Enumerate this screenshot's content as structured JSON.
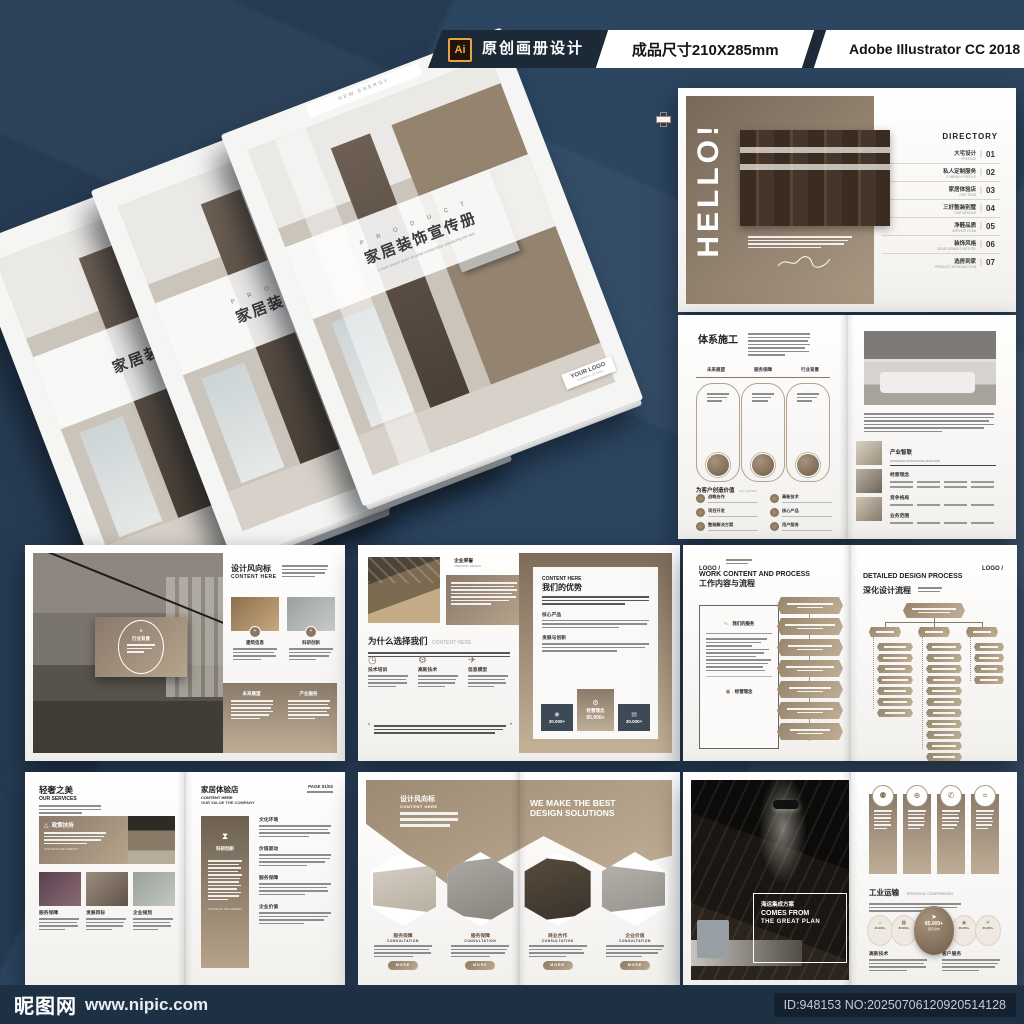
{
  "banner": {
    "ai_badge": "Ai",
    "label": "原创画册设计",
    "size": "成品尺寸210X285mm",
    "software": "Adobe Illustrator CC 2018"
  },
  "footer": {
    "brand": "昵图网",
    "url": "www.nipic.com",
    "id_no": "ID:948153 NO:20250706120920514128"
  },
  "cover": {
    "tab": "NEW ENERGY",
    "eyebrow": "P R O D U C T",
    "title": "家居装饰宣传册",
    "subtitle": "Lorem ipsum dolor sit amet consectetur adipiscing elit sed",
    "logo": "YOUR LOGO",
    "logo_sub": "COMPANY DESIGN"
  },
  "hello": {
    "title": "HELLO!",
    "directory": "DIRECTORY",
    "items": [
      {
        "cn": "大宅设计",
        "en": "PREFACE",
        "num": "01"
      },
      {
        "cn": "私人定制服务",
        "en": "COMPANY PROFILE",
        "num": "02"
      },
      {
        "cn": "家居体验店",
        "en": "OUR TEAM",
        "num": "03"
      },
      {
        "cn": "三好整装别墅",
        "en": "OUR SERVICE",
        "num": "04"
      },
      {
        "cn": "净醛品质",
        "en": "SERVICE FLOW",
        "num": "05"
      },
      {
        "cn": "装饰风格",
        "en": "DEVELOPMENT HISTORY",
        "num": "06"
      },
      {
        "cn": "选房到家",
        "en": "PRODUCT INTRODUCTION",
        "num": "07"
      }
    ]
  },
  "system": {
    "title": "体系施工",
    "cols": [
      "未来展望",
      "服务保障",
      "行业背景"
    ],
    "value_title": "为客户创造价值",
    "value_sub": "ALL LAYOUT",
    "value_items": [
      "战略合作",
      "项目开发",
      "整装解决方案",
      "高新技术",
      "核心产品",
      "用户服务"
    ],
    "industry_title": "产业智联",
    "industry_sub": "STRATEGIC POSITIONING FUNCTION",
    "industry_items": [
      "经营理念",
      "竞争格局",
      "业务范围"
    ]
  },
  "design": {
    "card_label": "行业背景",
    "quote_open": "❝",
    "quote_close": "❞",
    "title": "设计风向标",
    "sub": "CONTENT HERE",
    "photo_labels": [
      "建筑信息",
      "科研创新"
    ],
    "bottom_cols": [
      "未来展望",
      "产业服务"
    ]
  },
  "why": {
    "corner_cn": "企业荣誉",
    "corner_en": "CREATIVE / DESIGN",
    "heading_cn": "为什么选择我们",
    "heading_en": "CONTENT HERE",
    "features": [
      "技术培训",
      "高新技术",
      "信息模型"
    ],
    "right_en": "CONTENT HERE",
    "right_cn": "我们的优势",
    "sections": [
      "核心产品",
      "发展与创新"
    ],
    "stat_left": "30.000+",
    "stat_center_label": "经营理念",
    "stat_center": "85.000+",
    "stat_right": "30.000+"
  },
  "process": {
    "logo": "LOGO /",
    "left_en": "WORK CONTENT AND PROCESS",
    "left_cn": "工作内容与流程",
    "box_title": "我们的服务",
    "box_footer": "经营理念",
    "right_en": "DETAILED DESIGN PROCESS",
    "right_cn": "深化设计流程"
  },
  "services": {
    "title_cn": "轻奢之美",
    "title_en": "OUR SERVICES",
    "banner_label": "政策扶持",
    "banner_sub": "OUR VALUE THE COMPANY",
    "photo_labels": [
      "服务保障",
      "发展目标",
      "企业规划"
    ],
    "r_title": "家居体验店",
    "r_sub1": "CONTENT HERE",
    "r_sub2": "OUR VALUE THE COMPANY",
    "page": "PAGE 01/02",
    "card_label": "科研创新",
    "sections": [
      "文化环境",
      "价值驱动",
      "服务保障",
      "企业价值"
    ]
  },
  "solutions": {
    "l_cn": "设计风向标",
    "l_en": "CONTENT HERE",
    "r_line1": "WE MAKE THE BEST",
    "r_line2": "DESIGN SOLUTIONS",
    "items": [
      {
        "cn": "服务保障",
        "en": "CONSULTATION"
      },
      {
        "cn": "服务保障",
        "en": "CONSULTATION"
      },
      {
        "cn": "商业合作",
        "en": "CONSULTATION"
      },
      {
        "cn": "企业价值",
        "en": "CONSULTATION"
      }
    ],
    "more": "MORE"
  },
  "plan": {
    "box_cn": "海运集成方案",
    "box_en1": "COMES FROM",
    "box_en2": "THE GREAT PLAN",
    "heading": "工业运输",
    "heading_en": "STRATEGIC COOPERATION",
    "small_stat": "30.000+",
    "big_stat": "85.000+",
    "big_label": "团队协作",
    "labels": [
      "高新技术",
      "客户服务"
    ]
  }
}
